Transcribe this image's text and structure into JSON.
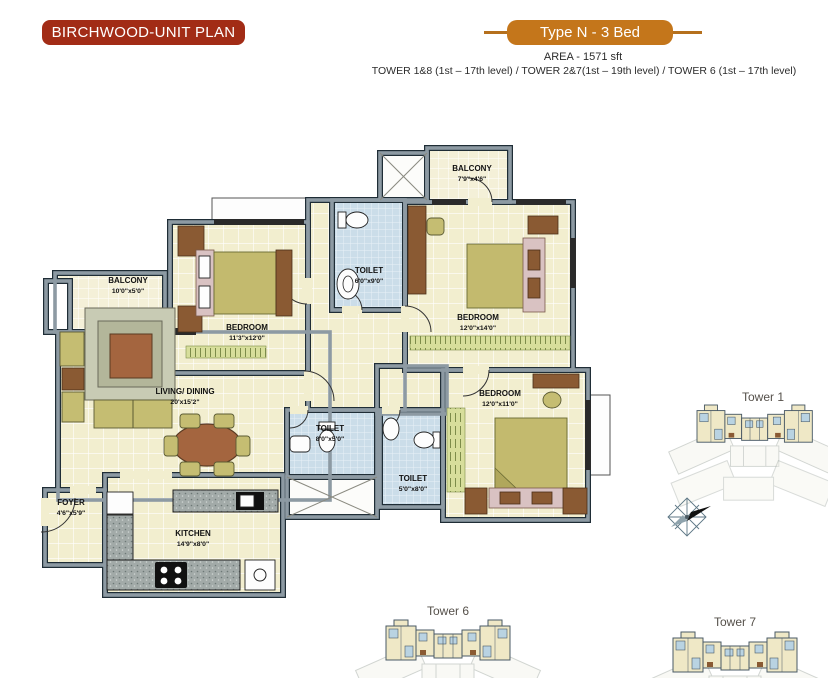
{
  "header": {
    "plan_badge": "BIRCHWOOD-UNIT PLAN",
    "type_badge": "Type N - 3 Bed",
    "area_line": "AREA - 1571 sft",
    "tower_line": "TOWER 1&8 (1st – 17th level) / TOWER 2&7(1st – 19th level) / TOWER 6 (1st – 17th level)"
  },
  "floor_plan": {
    "rooms": [
      {
        "name": "BALCONY",
        "dims": "10'0\"x5'0\""
      },
      {
        "name": "BEDROOM",
        "dims": "11'3\"x12'0\""
      },
      {
        "name": "TOILET",
        "dims": "6'0\"x9'0\""
      },
      {
        "name": "BALCONY",
        "dims": "7'9\"x4'6\""
      },
      {
        "name": "BEDROOM",
        "dims": "12'0\"x14'0\""
      },
      {
        "name": "LIVING/ DINING",
        "dims": "20'x15'2\""
      },
      {
        "name": "TOILET",
        "dims": "8'0\"x5'0\""
      },
      {
        "name": "TOILET",
        "dims": "5'0\"x8'0\""
      },
      {
        "name": "BEDROOM",
        "dims": "12'0\"x11'0\""
      },
      {
        "name": "FOYER",
        "dims": "4'6\"x5'9\""
      },
      {
        "name": "KITCHEN",
        "dims": "14'9\"x8'0\""
      }
    ]
  },
  "towers": [
    {
      "label": "Tower 1"
    },
    {
      "label": "Tower 6"
    },
    {
      "label": "Tower 7"
    }
  ],
  "colors": {
    "plan_badge_bg": "#a22c16",
    "type_badge_bg": "#c4761b",
    "wall": "#8d9aa3",
    "floor": "#f2eecf",
    "toilet_tile": "#cbdde9",
    "wood": "#8a5a33",
    "mattress": "#c3ba6e",
    "runner_green": "#d7de9b",
    "counter_granite": "#a2aaa8"
  }
}
